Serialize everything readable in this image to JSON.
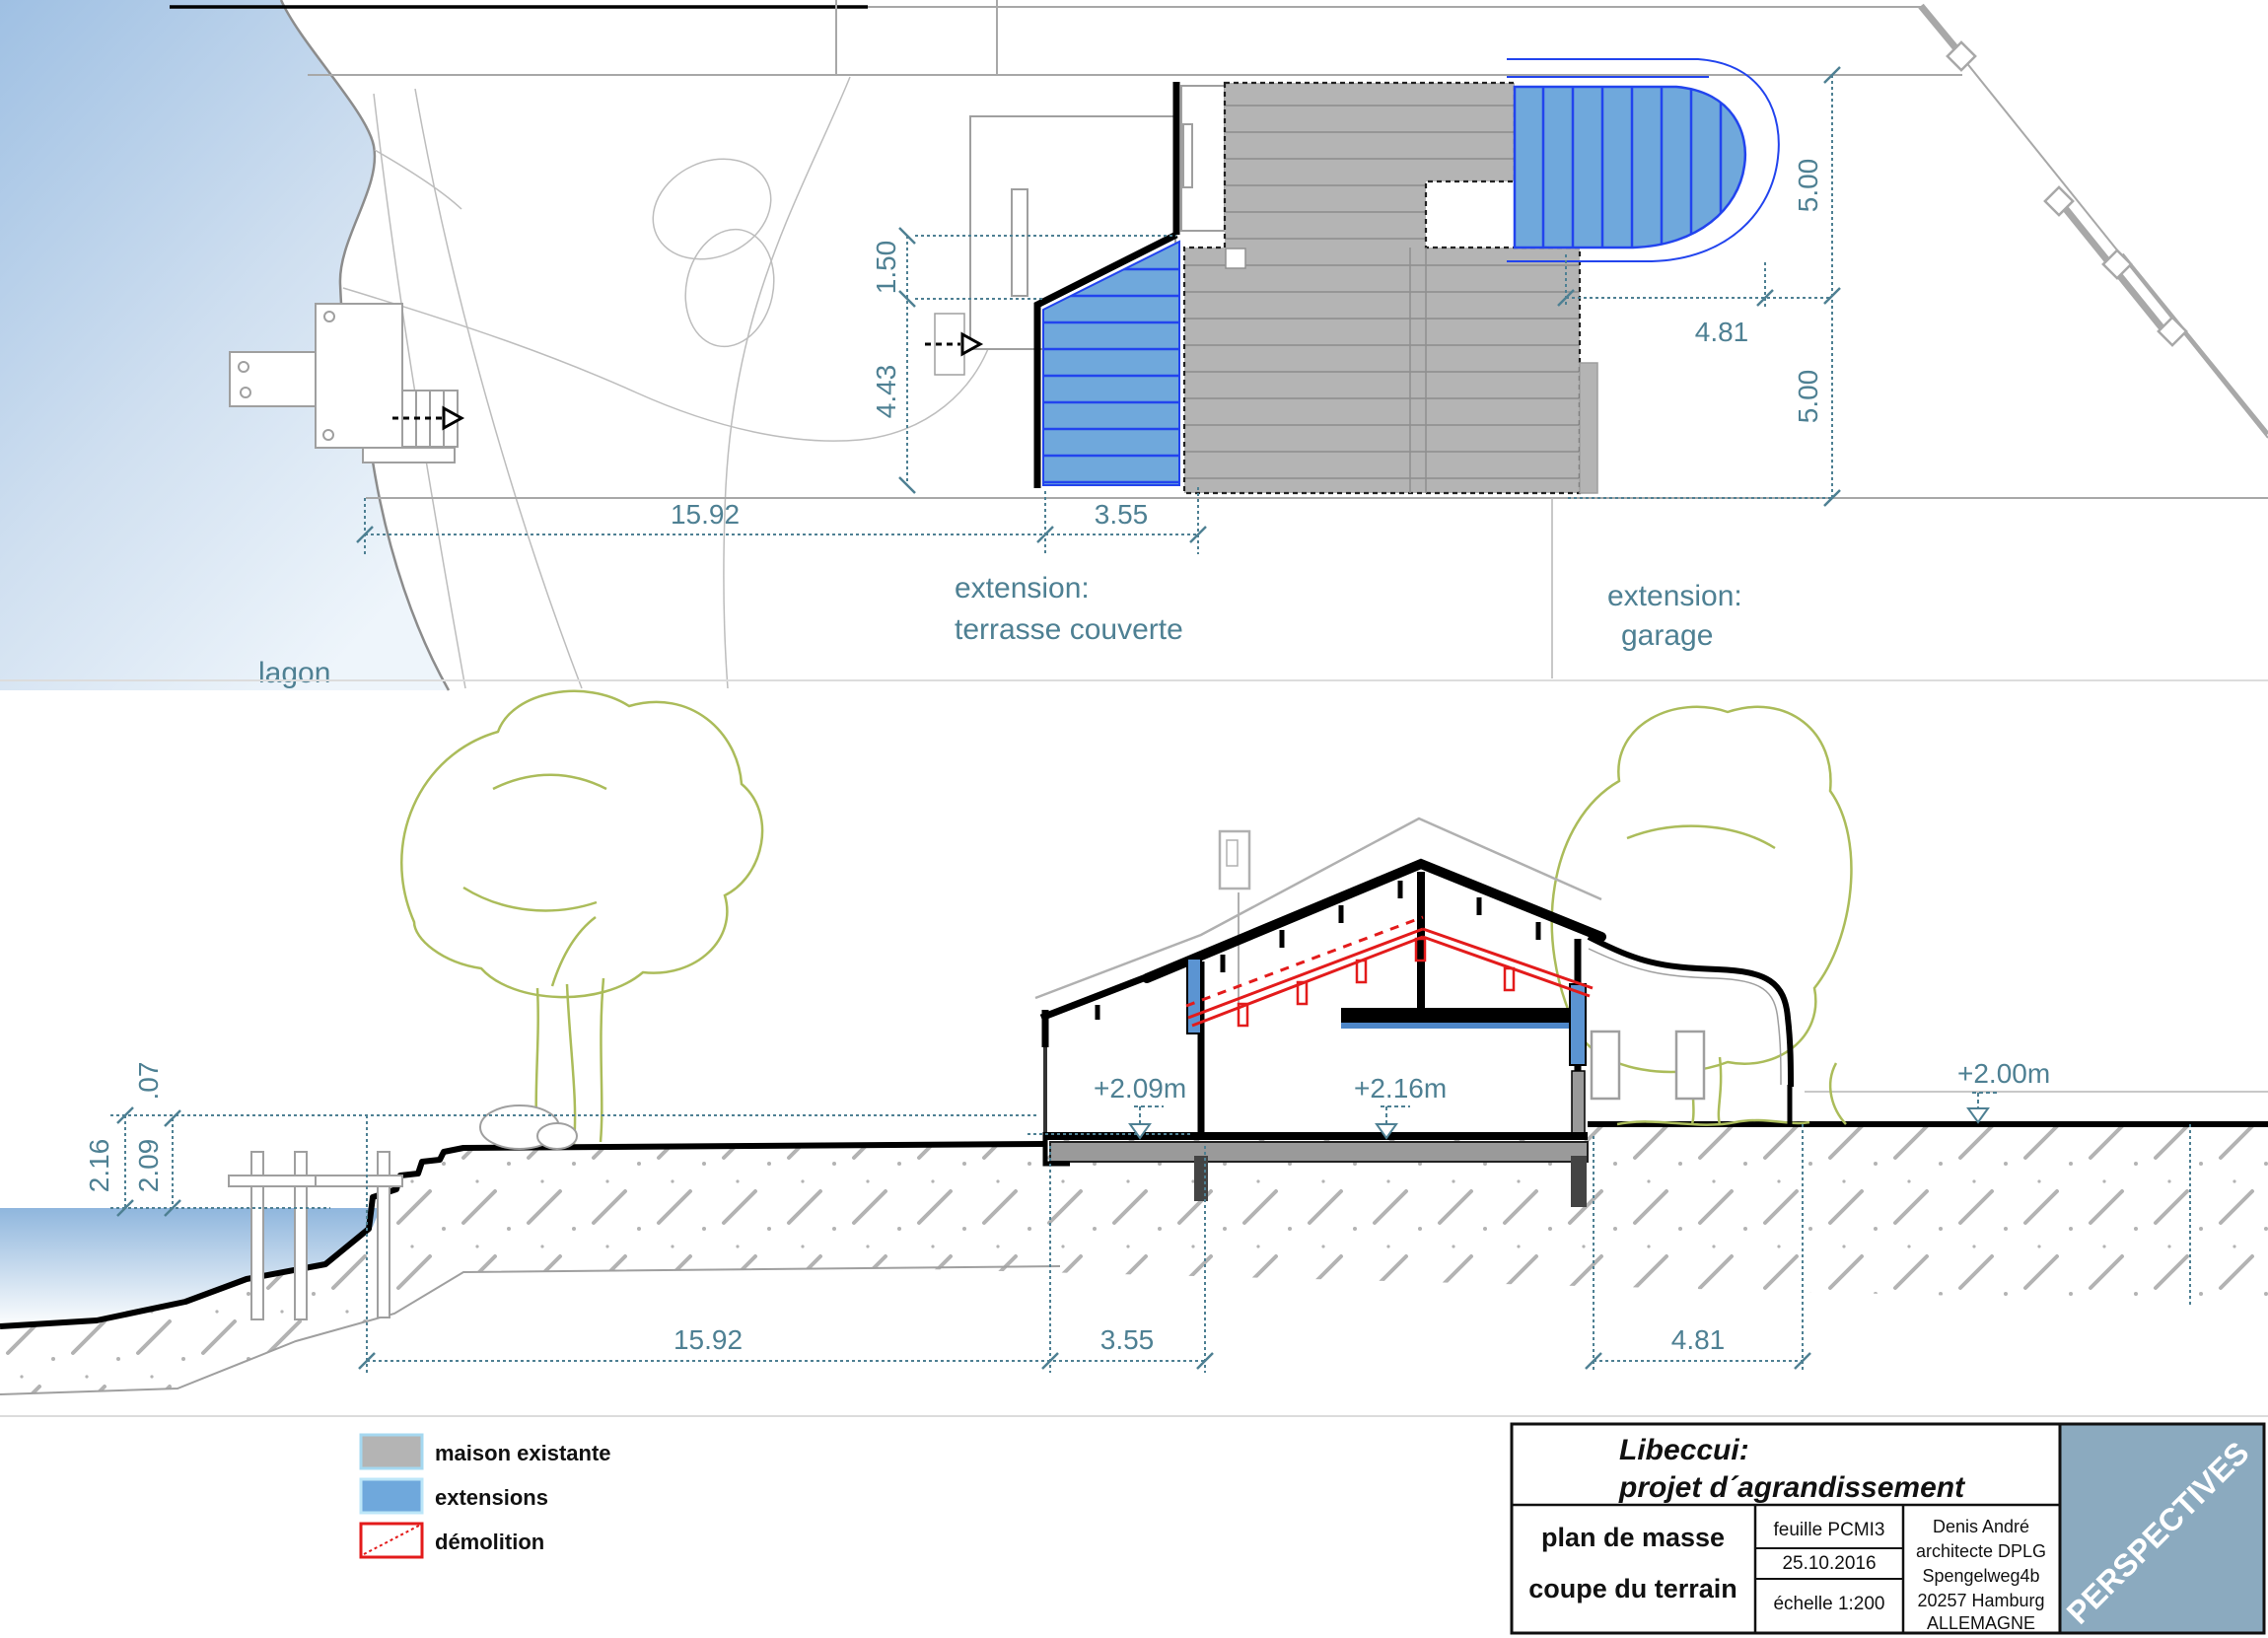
{
  "colors": {
    "dim_teal": "#4e8093",
    "extension_blue": "#6fa8dc",
    "stripe_blue": "#2244ee",
    "existing_gray": "#b4b4b4",
    "demolition_red": "#e31b1b",
    "tree_olive": "#abbc5a",
    "perspectives_bg": "#8baabf"
  },
  "plan": {
    "lagoon_label": "lagon",
    "extension_terrace": {
      "line1": "extension:",
      "line2": "terrasse couverte"
    },
    "extension_garage": {
      "line1": "extension:",
      "line2": "garage"
    },
    "dims": {
      "width_main": "15.92",
      "width_terrace": "3.55",
      "terrace_step": "1.50",
      "terrace_depth": "4.43",
      "garage_width": "4.81",
      "parcel_upper": "5.00",
      "parcel_lower": "5.00"
    }
  },
  "section": {
    "levels": {
      "terrace": "+2.09m",
      "house": "+2.16m",
      "garden": "+2.00m"
    },
    "dims": {
      "water_total": "2.16",
      "water_terrace": "2.09",
      "level_diff": ".07",
      "width_main": "15.92",
      "width_terrace": "3.55",
      "garage_width": "4.81"
    }
  },
  "legend": {
    "items": [
      {
        "label": "maison existante"
      },
      {
        "label": "extensions"
      },
      {
        "label": "démolition"
      }
    ]
  },
  "title_block": {
    "project": {
      "line1": "Libeccui:",
      "line2": "projet d´agrandissement"
    },
    "drawing": {
      "line1": "plan de masse",
      "line2": "coupe du terrain"
    },
    "sheet": "feuille PCMI3",
    "date": "25.10.2016",
    "scale": "échelle 1:200",
    "architect": {
      "line1": "Denis André",
      "line2": "architecte DPLG",
      "line3": "Spengelweg4b",
      "line4": "20257 Hamburg",
      "line5": "ALLEMAGNE"
    },
    "side_label": "PERSPECTIVES"
  }
}
